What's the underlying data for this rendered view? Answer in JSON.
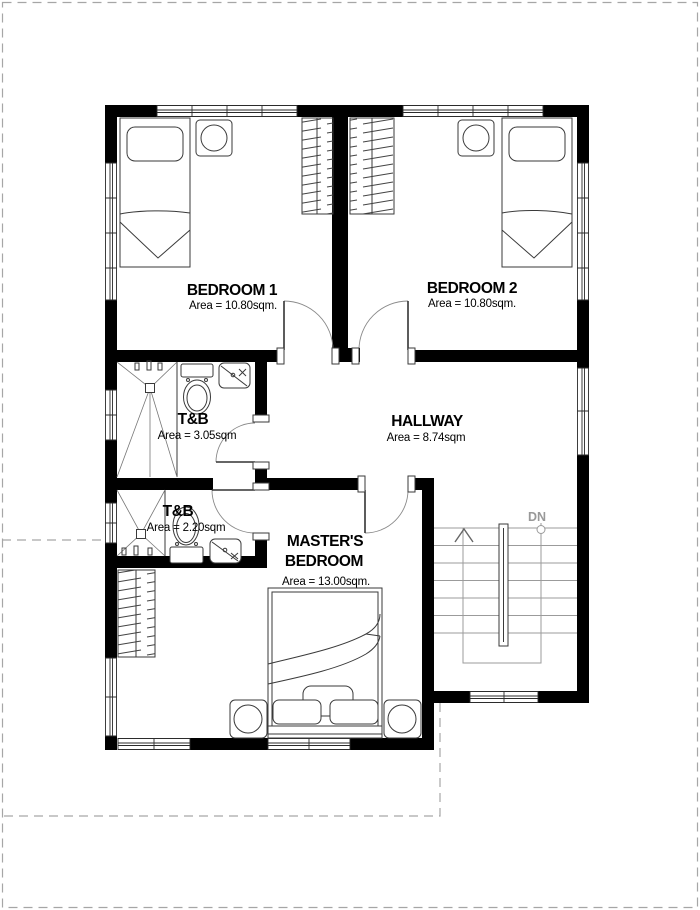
{
  "page": {
    "background": "#ffffff",
    "border_color": "#a6a6a6"
  },
  "plan": {
    "colors": {
      "wall": "#000000",
      "furniture_line": "#3a3a3a",
      "stair_line": "#9b9b9b",
      "dashed_line": "#a6a6a6",
      "dn_label": "#999999"
    },
    "rooms": {
      "bedroom1": {
        "name": "BEDROOM 1",
        "area": "Area = 10.80sqm."
      },
      "bedroom2": {
        "name": "BEDROOM 2",
        "area": "Area = 10.80sqm."
      },
      "tb1": {
        "name": "T&B",
        "area": "Area = 3.05sqm"
      },
      "tb2": {
        "name": "T&B",
        "area": "Area = 2.20sqm"
      },
      "hallway": {
        "name": "HALLWAY",
        "area": "Area = 8.74sqm"
      },
      "master": {
        "name_line1": "MASTER'S",
        "name_line2": "BEDROOM",
        "area": "Area = 13.00sqm."
      }
    },
    "stairs": {
      "down_label": "DN"
    }
  }
}
